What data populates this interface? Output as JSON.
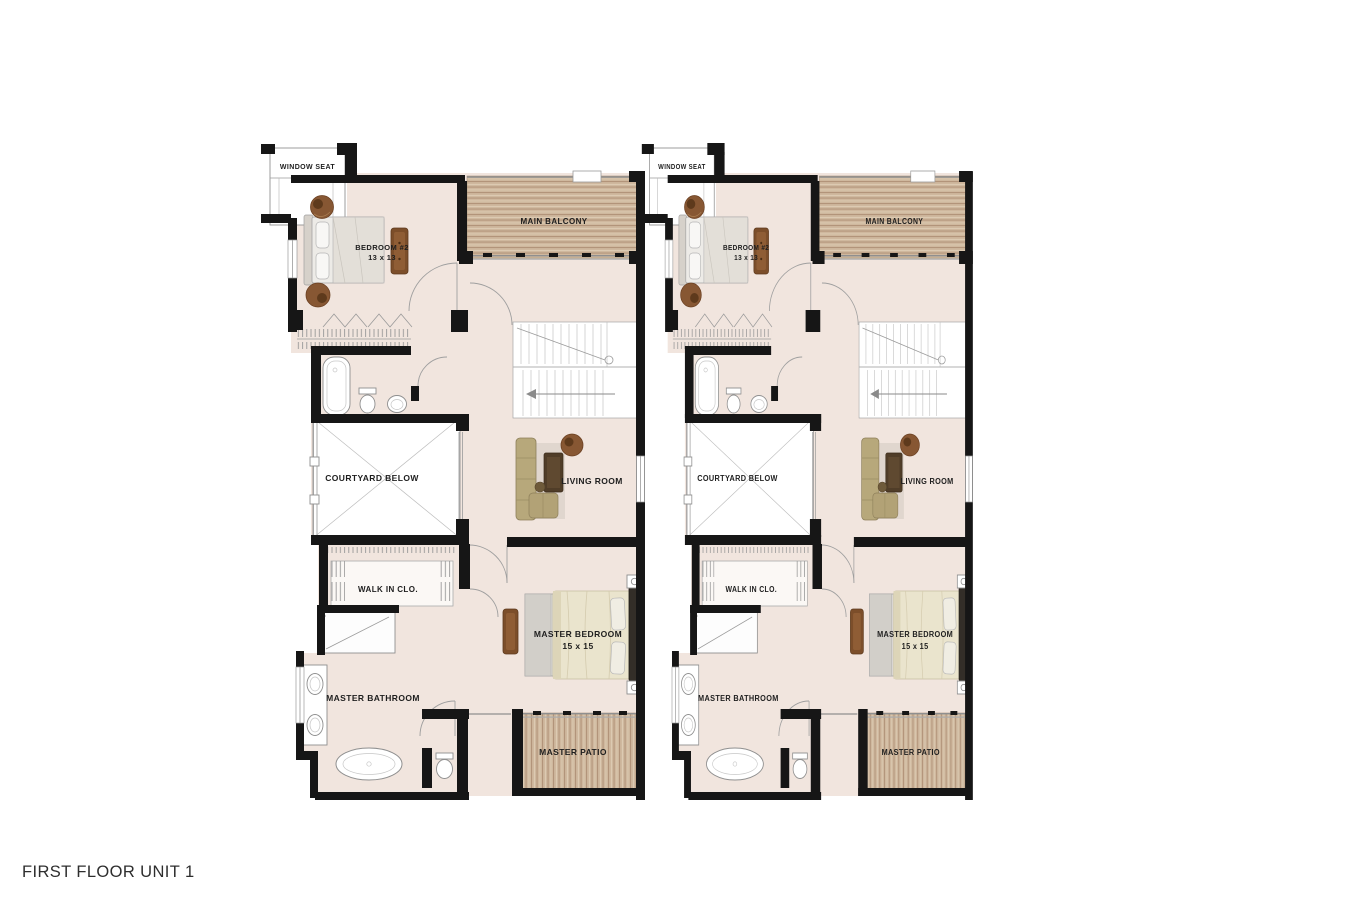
{
  "page": {
    "title": "FIRST FLOOR UNIT 1"
  },
  "colors": {
    "background": "#ffffff",
    "floor": "#f1e5de",
    "wall": "#161616",
    "deck_wood": "#cfb89e",
    "deck_wood_dark": "#ab8d6f",
    "label_text": "#1e1e1e",
    "furniture_wood": "#7c4e2a",
    "sofa_tan": "#b7a87b",
    "duvet_cream": "#eae4cd"
  },
  "units": [
    {
      "id": "unit-1",
      "labels": {
        "window_seat": "WINDOW SEAT",
        "main_balcony": "MAIN BALCONY",
        "bedroom2": "BEDROOM #2",
        "bedroom2_dim": "13 x 13",
        "courtyard": "COURTYARD BELOW",
        "living_room": "LIVING ROOM",
        "walk_in_closet": "WALK IN CLO.",
        "master_bedroom": "MASTER BEDROOM",
        "master_bedroom_dim": "15 x 15",
        "master_bathroom": "MASTER BATHROOM",
        "master_patio": "MASTER PATIO"
      }
    },
    {
      "id": "unit-2",
      "labels": {
        "window_seat": "WINDOW SEAT",
        "main_balcony": "MAIN BALCONY",
        "bedroom2": "BEDROOM #2",
        "bedroom2_dim": "13 x 13",
        "courtyard": "COURTYARD BELOW",
        "living_room": "LIVING ROOM",
        "walk_in_closet": "WALK IN CLO.",
        "master_bedroom": "MASTER BEDROOM",
        "master_bedroom_dim": "15 x 15",
        "master_bathroom": "MASTER BATHROOM",
        "master_patio": "MASTER PATIO"
      }
    }
  ]
}
